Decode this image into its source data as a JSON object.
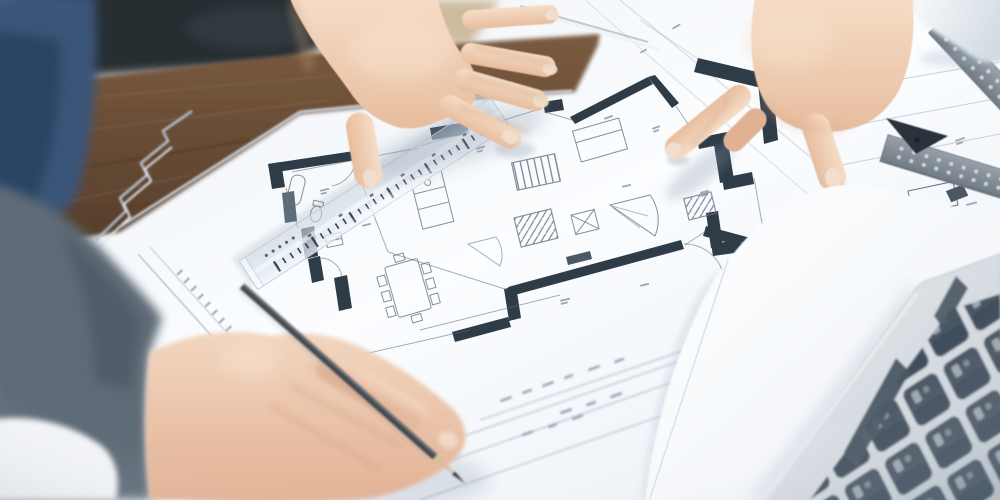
{
  "scene": {
    "description": "Close-up photograph of architects' hands over an architectural floor plan on a desk: one hand rests flat on the blueprint, a second hand points at a wall detail, a third blurred hand in the foreground holds a pencil; a transparent scale ruler lies diagonally across the plan, with a metal set square, a rolled drawing and a silver laptop keyboard at the edges of the frame.",
    "objects": {
      "desk_wood": "wooden desk edge",
      "chair": "black leather chair back",
      "denim": "blue denim sleeve",
      "paper_stack": "stacked blueprint sheets",
      "floor_plan": "architectural floor plan drawing",
      "walls": "dark plan wall segments",
      "furniture": "plan furniture symbols",
      "dining_table": "dining table with chairs symbol",
      "margin_text": "illegible plan margin text",
      "title_block": "illegible plan title block",
      "ruler": "transparent scale ruler",
      "pencil": "graphite pencil",
      "resting_hand": "hand resting on plan",
      "pointing_hand": "hand pointing at plan",
      "pencil_hand": "blurred hand holding pencil",
      "sweater": "gray sweater sleeve",
      "cuff": "white shirt cuff",
      "sleeve_right": "white shirt sleeve",
      "set_square": "metal set square",
      "rolled_drawing": "rolled white drawing",
      "laptop": "silver laptop keyboard",
      "bright_sheet": "bright white paper sheet"
    }
  },
  "colors": {
    "paper": "#f7fafd",
    "paper_dim": "#e4eaf2",
    "edge_line": "#ccd6e2",
    "line_ink": "#5f6c7c",
    "wall_ink": "#2e3c48",
    "wall_soft": "#5d6e7a",
    "wood": "#7b5b40",
    "wood_dark": "#543d2a",
    "wood_grain": "#8f6e4f",
    "leather": "#262d33",
    "tan_bg": "#cdbb9f",
    "denim": "#3a5578",
    "sweater": "#5f6a77",
    "shirt_white": "#f2f4f7",
    "skin_light": "#f6ddc7",
    "skin_mid": "#e7bd9e",
    "skin_shadow": "#c89a7b",
    "nail": "#f2e0cf",
    "ruler_tick": "#313c48",
    "pencil_body": "#43484d",
    "pencil_wood": "#d8c09b",
    "pencil_tip": "#2e3236",
    "laptop_silver": "#eceef0",
    "laptop_silver_dark": "#c3ccd4",
    "laptop_key": "#4a5664",
    "key_glyph": "#e4e9ee",
    "metal": "#98a1a9",
    "metal_dark": "#6f7a83",
    "metal_vertex": "#2b333b",
    "dim_mark": "#76839a",
    "shadow_cool": "#8b99ac"
  }
}
